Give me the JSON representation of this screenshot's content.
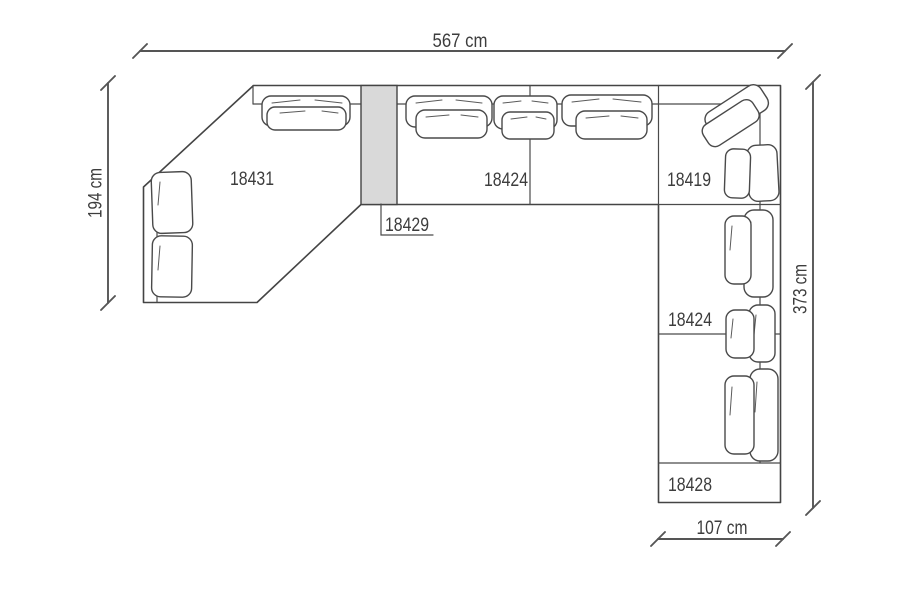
{
  "diagram": {
    "type": "furniture-floorplan",
    "units": "cm",
    "colors": {
      "background": "#ffffff",
      "line": "#444444",
      "dimension_line": "#555555",
      "text": "#3d3d3d",
      "connector_fill": "#d9d9d9"
    },
    "dims": {
      "top": {
        "label": "567 cm"
      },
      "left": {
        "label": "194 cm"
      },
      "right": {
        "label": "373 cm"
      },
      "bottom": {
        "label": "107 cm"
      }
    },
    "modules": {
      "chaise": {
        "label": "18431"
      },
      "top_sofa": {
        "label": "18424"
      },
      "corner": {
        "label": "18419"
      },
      "connector": {
        "label": "18429"
      },
      "right_sofa": {
        "label": "18424"
      },
      "bench": {
        "label": "18428"
      }
    }
  }
}
